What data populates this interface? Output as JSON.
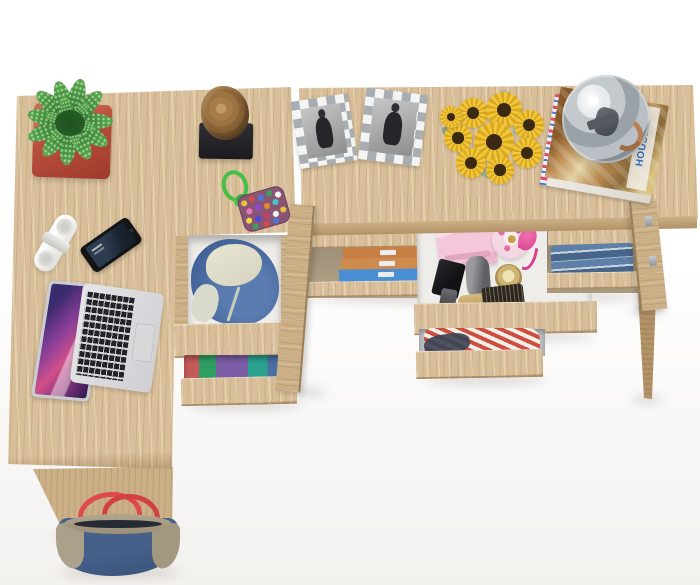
{
  "scene": {
    "type": "product-photo",
    "description": "Top-down view of a light Sonoma oak corner desk and matching dresser with open drawers and doors, styled with accessories, on a white background"
  },
  "palette": {
    "bg_top": "#ffffff",
    "bg_bottom": "#f3f1ee",
    "wood": "#d9bf99",
    "wood_dark": "#cbb087",
    "wood_deep": "#b29267",
    "interior": "#efedea",
    "compartment_shade": "#7d7060",
    "hoodie_blue": "#48699e",
    "hoodie_lining": "#e9e6d4",
    "clothes_red": "#c45a5a",
    "clothes_green": "#2f9e63",
    "clothes_purple": "#7b5ea6",
    "clothes_teal": "#2aa18e",
    "box_orange": "#c87f44",
    "box_orange_light": "#cf8a4d",
    "box_blue": "#4a8fd4",
    "jeans_blue": "#5d7fa8",
    "jeans_dark": "#47648a",
    "dark_garment": "#2e3237",
    "pink_box": "#f4c8da",
    "perfume_pink": "#d8408c",
    "gold_jar": "#cdb472",
    "shirt_stripe_red": "#cd4e3e",
    "pot_red": "#bb4f3e",
    "leaf_green": "#3d8c3a",
    "sunflower_yellow": "#eec235",
    "sunflower_center": "#3a2a12",
    "screen_pink": "#d04f8a",
    "magazine_blue": "#2f6fc0",
    "lamp_glass": "#c3c9cd",
    "lamp_copper": "#b87f55",
    "bag_blue": "#46608a",
    "bag_khaki": "#aba08a",
    "strap_red": "#e0484d",
    "cord_green": "#46bf46",
    "stump_brown": "#a87c48"
  },
  "l_desk": {
    "surface_items": [
      {
        "name": "potted-succulent",
        "pot_color": "#bb4f3e"
      },
      {
        "name": "white-portable-speaker"
      },
      {
        "name": "smartphone"
      },
      {
        "name": "silver-laptop-open"
      },
      {
        "name": "wood-stump-on-black-base"
      },
      {
        "name": "multicolor-bead-pouch-with-green-cord"
      }
    ],
    "pedestal": {
      "drawer_1_contents": "blue hooded sweatshirt with cream lining",
      "drawer_2_contents": "folded shirts in red, green, purple and teal"
    },
    "hanging_bag": "navy and khaki handbag with red straps"
  },
  "dresser": {
    "surface_items": [
      {
        "name": "photo-frame-left",
        "style": "silver checkered frame, black and white portrait"
      },
      {
        "name": "photo-frame-right",
        "style": "silver checkered frame, black and white portrait"
      },
      {
        "name": "sunflower-bouquet"
      },
      {
        "name": "magazine-stack"
      },
      {
        "name": "glass-dome-lamp"
      }
    ],
    "magazine_title": "HOUSE BEAUTIFUL",
    "left_compartment": {
      "shelf_top": "folded blue and white clothes",
      "shelf_bottom": "two orange boxes and one blue box with white handles"
    },
    "middle_drawers": {
      "top_drawer_contents": [
        "pink gift box",
        "pink atomizer perfume",
        "black perfume bottle",
        "grey flask",
        "small grey bottle",
        "cream jar",
        "wooden hairbrush"
      ],
      "bottom_drawer_contents": "red and white striped shirt with navy garment"
    },
    "right_compartment": {
      "shelf_top": "dark folded garments and cream roll",
      "shelf_bottom": "stack of folded jeans"
    },
    "doors": "left and right doors open with metal hinges"
  }
}
